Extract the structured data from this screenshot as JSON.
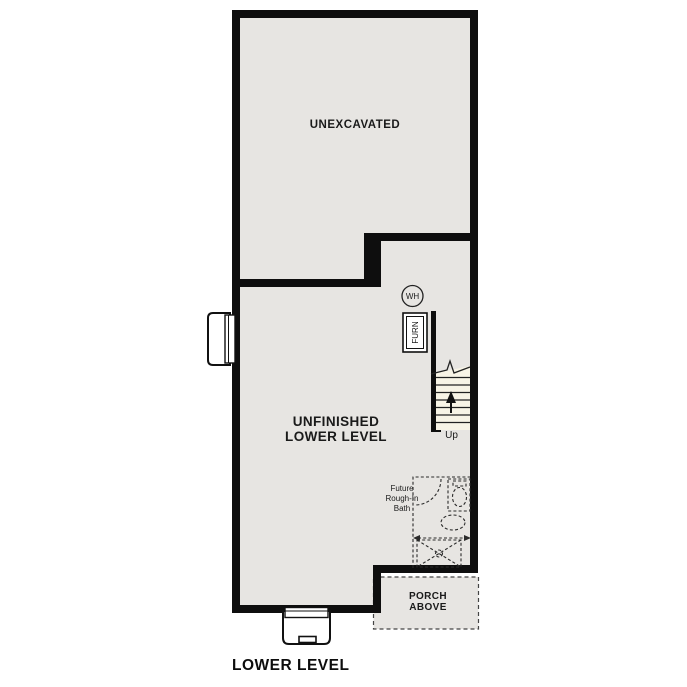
{
  "plan": {
    "title": "LOWER LEVEL"
  },
  "rooms": {
    "unexcavated": {
      "label": "UNEXCAVATED"
    },
    "lower_level": {
      "label_line1": "UNFINISHED",
      "label_line2": "LOWER LEVEL"
    },
    "bath": {
      "label_line1": "Future",
      "label_line2": "Rough-In",
      "label_line3": "Bath"
    },
    "porch": {
      "label_line1": "PORCH",
      "label_line2": "ABOVE"
    }
  },
  "fixtures": {
    "water_heater": {
      "label": "WH"
    },
    "furnace": {
      "label": "FURN"
    },
    "stairs": {
      "direction_label": "Up"
    }
  },
  "colors": {
    "wall": "#0e0e0e",
    "floor": "#e7e5e2",
    "stair_tread": "#f8f4e6",
    "dashed_line": "#2b2b2b",
    "page_background": "#ffffff"
  }
}
